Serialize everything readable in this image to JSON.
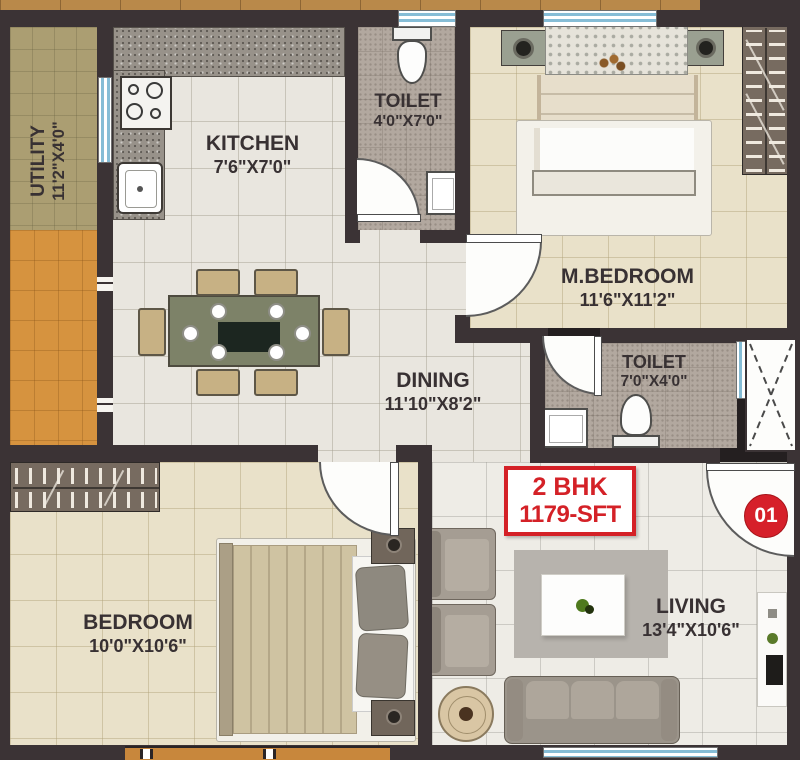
{
  "plan": {
    "badge": {
      "line1": "2 BHK",
      "line2": "1179-SFT"
    },
    "unit_number": "01",
    "rooms": {
      "utility": {
        "name": "UTILITY",
        "dims": "11'2\"X4'0\""
      },
      "kitchen": {
        "name": "KITCHEN",
        "dims": "7'6\"X7'0\""
      },
      "toilet_top": {
        "name": "TOILET",
        "dims": "4'0\"X7'0\""
      },
      "master_bedroom": {
        "name": "M.BEDROOM",
        "dims": "11'6\"X11'2\""
      },
      "dining": {
        "name": "DINING",
        "dims": "11'10\"X8'2\""
      },
      "toilet_master": {
        "name": "TOILET",
        "dims": "7'0\"X4'0\""
      },
      "bedroom": {
        "name": "BEDROOM",
        "dims": "10'0\"X10'6\""
      },
      "living": {
        "name": "LIVING",
        "dims": "13'4\"X10'6\""
      }
    },
    "colors": {
      "accent_red": "#d42127",
      "wall": "#3b3335"
    }
  }
}
